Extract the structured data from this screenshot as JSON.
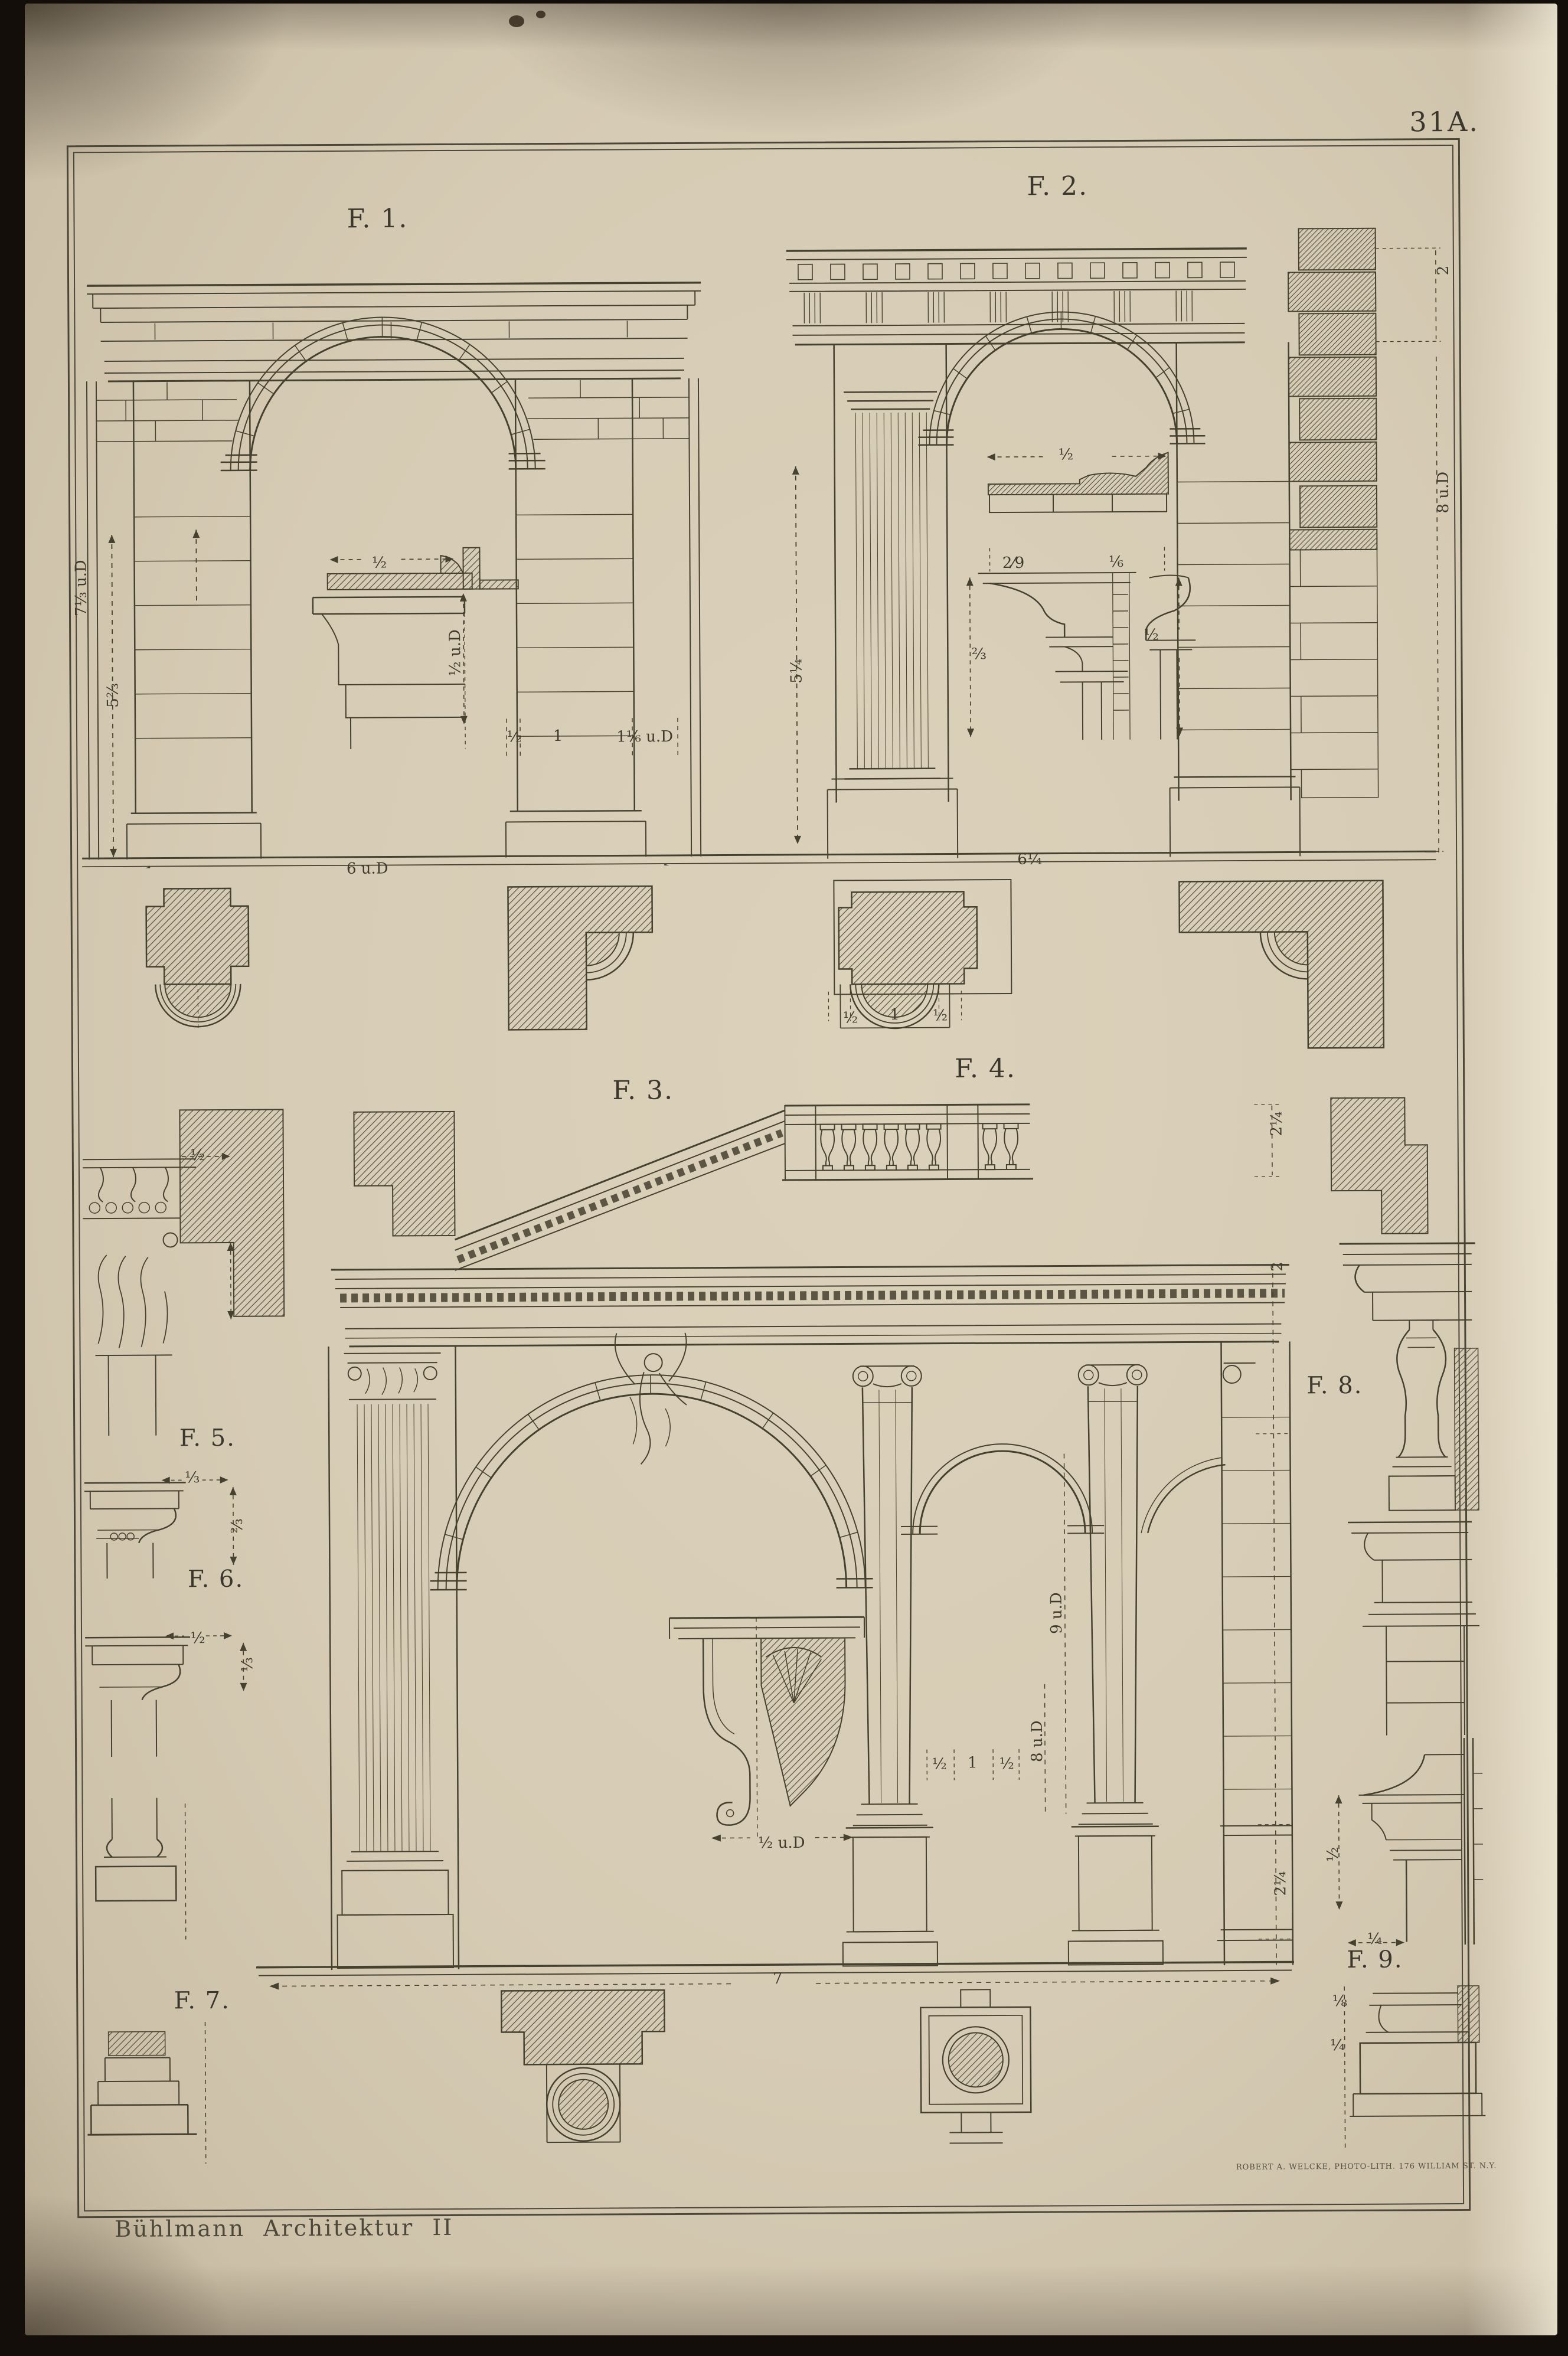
{
  "plate": {
    "number": "31A.",
    "caption_left": "Bühlmann Architektur II",
    "caption_right": "ROBERT A. WELCKE, PHOTO-LITH. 176 WILLIAM ST. N.Y.",
    "ink_color": "#46402f",
    "paper_color": "#d6cbb4"
  },
  "figures": {
    "f1": {
      "label": "F. 1.",
      "dims": {
        "height_upper": "7⅓ u.D",
        "height_lower": "5⅔",
        "impost_width": "½",
        "impost_height": "½ u.D",
        "base_left": "½",
        "base_mid": "1",
        "base_right": "1⅙ u.D",
        "width": "6 u.D"
      }
    },
    "f2": {
      "label": "F. 2.",
      "dims": {
        "left_height": "5¼",
        "corner_top": "2",
        "right_height": "8 u.D",
        "width": "6¼",
        "profile_width": "½",
        "cap_top_left": "2⁄9",
        "cap_top_right": "⅙",
        "cap_height_left": "⅔",
        "cap_height_right": "½"
      }
    },
    "f3": {
      "label": "F. 3.",
      "dims": {
        "console_width": "½ u.D",
        "base_width": "7"
      }
    },
    "f4": {
      "label": "F. 4.",
      "dims": {
        "balustrade_height": "2¼",
        "frieze_height": "2",
        "arch_height": "9 u.D",
        "column_height": "8 u.D",
        "column_left": "½",
        "column_mid": "1",
        "column_right": "½",
        "pedestal_height": "2¼"
      }
    },
    "f5": {
      "label": "F. 5.",
      "dims": {
        "cornice_width": "½"
      }
    },
    "f6": {
      "label": "F. 6.",
      "dims": {
        "abacus_width": "⅓",
        "cap_height": "⅔"
      }
    },
    "f7": {
      "label": "F. 7.",
      "dims": {
        "abacus_width": "½",
        "cap_height": "⅓"
      }
    },
    "f8": {
      "label": "F. 8."
    },
    "f9": {
      "label": "F. 9.",
      "dims": {
        "cornice_height": "½",
        "offset_width": "¼",
        "base_upper": "⅛",
        "base_lower": "¼"
      }
    }
  },
  "plans": {
    "column_dims": {
      "left": "½",
      "center": "1",
      "right": "½"
    }
  }
}
